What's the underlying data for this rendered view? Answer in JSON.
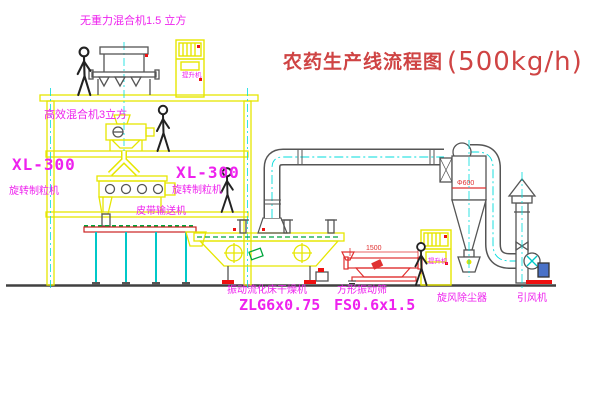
{
  "title": {
    "cn": "农药生产线流程图",
    "capacity": "(500kg/h)"
  },
  "colors": {
    "label_magenta": "#ee22ee",
    "title_red": "#cf4444",
    "machine_yellow": "#e6e600",
    "centerline_cyan": "#00dcdc",
    "hatch_green": "#00a53c",
    "dimension_red": "#e03030",
    "line_dark": "#555555",
    "motor_blue": "#4a72c8"
  },
  "labels": {
    "mixer_top": "无重力混合机1.5 立方",
    "mixer_mid": "高效混合机3立方",
    "granulator_model_left": "XL-300",
    "granulator_name_left": "旋转制粒机",
    "granulator_model_mid": "XL-300",
    "granulator_name_mid": "旋转制粒机",
    "belt_conveyor": "皮带输送机",
    "dryer_name": "振动流化床干燥机",
    "dryer_model": "ZLG6x0.75",
    "sifter_name": "方形振动筛",
    "sifter_model": "FS0.6x1.5",
    "cyclone": "旋风除尘器",
    "fan": "引风机",
    "elevator_top": "提升机",
    "elevator_right": "提升机",
    "dim_sifter": "1500",
    "dim_cyclone": "Φ600"
  }
}
